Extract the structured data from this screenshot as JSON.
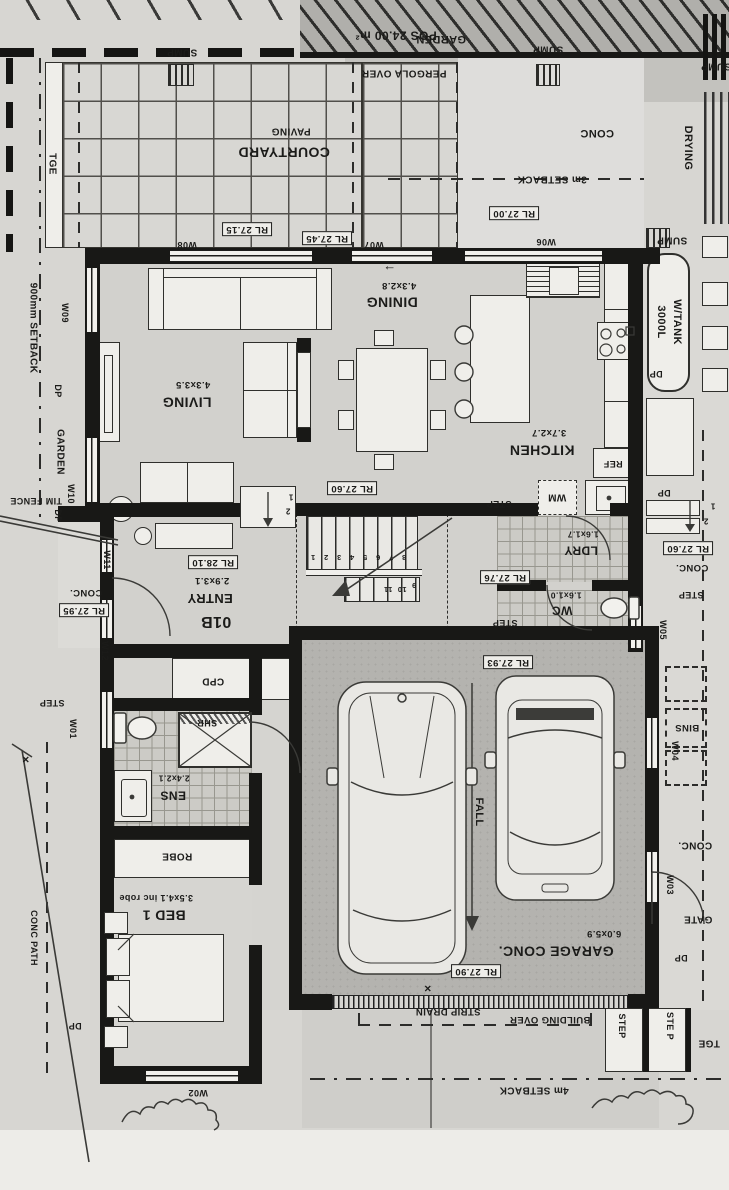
{
  "meta": {
    "drawing_type": "architectural floor plan (scanned, sheet rotated 180°)"
  },
  "colors": {
    "paper": "#d7d6d2",
    "wall": "#181816",
    "garage": "#b4b3af",
    "paving": "#d8d7d3",
    "exterior": "#dad9d5",
    "line": "#3a3a37"
  },
  "rooms": {
    "living": {
      "name": "LIVING",
      "dim": "4.3x3.5"
    },
    "dining": {
      "name": "DINING",
      "dim": "4.3x2.8"
    },
    "kitchen": {
      "name": "KITCHEN",
      "dim": "3.7x2.7"
    },
    "entry": {
      "name": "ENTRY",
      "dim": "2.9x3.1",
      "unit": "01B"
    },
    "ldry": {
      "name": "LDRY",
      "dim": "1.6x1.7"
    },
    "wc": {
      "name": "WC",
      "dim": "1.6x1.0"
    },
    "ens": {
      "name": "ENS",
      "dim": "2.4x2.1"
    },
    "bed1": {
      "name": "BED 1",
      "dim": "3.5x4.1 inc robe"
    },
    "garage": {
      "name": "GARAGE CONC.",
      "dim": "6.0x5.9"
    }
  },
  "levels": [
    "RL 27.00",
    "RL 27.15",
    "RL 27.45",
    "RL 27.60",
    "RL 27.60",
    "RL 27.76",
    "RL 27.90",
    "RL 27.93",
    "RL 27.95",
    "RL 28.10"
  ],
  "site_notes": [
    "POS 24.00 m²",
    "3m SETBACK",
    "4m SETBACK",
    "900mm SETBACK",
    "PERGOLA OVER",
    "BUILDING OVER",
    "STRIP DRAIN",
    "TIM FENCE",
    "CONC PATH",
    "3000L W/TANK",
    "DRYING",
    "BINS",
    "GATE"
  ],
  "labels": [
    {
      "id": "pos-area",
      "t": "POS 24.00 m²",
      "x": 396,
      "y": 35,
      "r": 180,
      "s": 12
    },
    {
      "id": "sump-1",
      "t": "SUMP",
      "x": 182,
      "y": 52,
      "r": 180,
      "s": 10
    },
    {
      "id": "garden-top",
      "t": "GARDEN",
      "x": 441,
      "y": 39,
      "r": 180,
      "s": 11
    },
    {
      "id": "sump-2",
      "t": "SUMP",
      "x": 548,
      "y": 49,
      "r": 180,
      "s": 10
    },
    {
      "id": "sump-3",
      "t": "SUMP",
      "x": 716,
      "y": 66,
      "r": 180,
      "s": 10
    },
    {
      "id": "pergola-over",
      "t": "PERGOLA OVER",
      "x": 404,
      "y": 73,
      "r": 180,
      "s": 10
    },
    {
      "id": "drying",
      "t": "DRYING",
      "x": 688,
      "y": 148,
      "r": 90,
      "s": 11
    },
    {
      "id": "paving",
      "t": "PAVING",
      "x": 291,
      "y": 131,
      "r": 180,
      "s": 10
    },
    {
      "id": "courtyard",
      "t": "COURTYARD",
      "x": 284,
      "y": 152,
      "r": 180,
      "s": 14
    },
    {
      "id": "tge-left",
      "t": "TGE",
      "x": 52,
      "y": 164,
      "r": 90,
      "s": 10
    },
    {
      "id": "conc-top",
      "t": "CONC",
      "x": 597,
      "y": 133,
      "r": 180,
      "s": 11
    },
    {
      "id": "setback-3m",
      "t": "3m SETBACK",
      "x": 552,
      "y": 179,
      "r": 180,
      "s": 10
    },
    {
      "id": "rl-27-00",
      "t": "RL 27.00",
      "x": 514,
      "y": 213,
      "r": 180,
      "s": 9.5,
      "box": true
    },
    {
      "id": "rl-27-15",
      "t": "RL 27.15",
      "x": 247,
      "y": 229,
      "r": 180,
      "s": 9.5,
      "box": true
    },
    {
      "id": "rl-27-45",
      "t": "RL 27.45",
      "x": 327,
      "y": 238,
      "r": 180,
      "s": 9.5,
      "box": true
    },
    {
      "id": "w08",
      "t": "W08",
      "x": 187,
      "y": 244,
      "r": 180,
      "s": 9
    },
    {
      "id": "w07",
      "t": "W07",
      "x": 374,
      "y": 244,
      "r": 180,
      "s": 9
    },
    {
      "id": "w06",
      "t": "W06",
      "x": 546,
      "y": 241,
      "r": 180,
      "s": 9
    },
    {
      "id": "sump-4",
      "t": "SUMP",
      "x": 672,
      "y": 240,
      "r": 180,
      "s": 10
    },
    {
      "id": "tank-line1",
      "t": "3000L",
      "x": 661,
      "y": 322,
      "r": 90,
      "s": 11
    },
    {
      "id": "tank-line2",
      "t": "W/TANK",
      "x": 677,
      "y": 322,
      "r": 90,
      "s": 11
    },
    {
      "id": "dp-tank",
      "t": "DP",
      "x": 656,
      "y": 373,
      "r": 180,
      "s": 9
    },
    {
      "id": "dining-arrow",
      "t": "←",
      "x": 390,
      "y": 266,
      "r": 0,
      "s": 13
    },
    {
      "id": "dining-dim",
      "t": "4.3x2.8",
      "x": 399,
      "y": 285,
      "r": 180,
      "s": 9.5
    },
    {
      "id": "dining",
      "t": "DINING",
      "x": 392,
      "y": 302,
      "r": 180,
      "s": 14
    },
    {
      "id": "living-dim",
      "t": "4.3x3.5",
      "x": 193,
      "y": 384,
      "r": 180,
      "s": 9.5
    },
    {
      "id": "living",
      "t": "LIVING",
      "x": 187,
      "y": 402,
      "r": 180,
      "s": 14
    },
    {
      "id": "w09",
      "t": "W09",
      "x": 64,
      "y": 313,
      "r": 90,
      "s": 9
    },
    {
      "id": "dp-left-1",
      "t": "DP",
      "x": 57,
      "y": 391,
      "r": 90,
      "s": 9
    },
    {
      "id": "garden-left",
      "t": "GARDEN",
      "x": 60,
      "y": 452,
      "r": 90,
      "s": 10
    },
    {
      "id": "w10",
      "t": "W10",
      "x": 70,
      "y": 494,
      "r": 90,
      "s": 9
    },
    {
      "id": "dp-left-2",
      "t": "DP",
      "x": 57,
      "y": 516,
      "r": 90,
      "s": 9
    },
    {
      "id": "tim-fence",
      "t": "TIM FENCE",
      "x": 36,
      "y": 500,
      "r": 180,
      "s": 9
    },
    {
      "id": "kitchen-dim",
      "t": "3.7x2.7",
      "x": 549,
      "y": 432,
      "r": 180,
      "s": 9.5
    },
    {
      "id": "kitchen",
      "t": "KITCHEN",
      "x": 542,
      "y": 450,
      "r": 180,
      "s": 14
    },
    {
      "id": "ref",
      "t": "REF",
      "x": 613,
      "y": 463,
      "r": 180,
      "s": 9
    },
    {
      "id": "rl-27-60-a",
      "t": "RL 27.60",
      "x": 352,
      "y": 488,
      "r": 180,
      "s": 9.5,
      "box": true
    },
    {
      "id": "wm",
      "t": "WM",
      "x": 557,
      "y": 497,
      "r": 180,
      "s": 10
    },
    {
      "id": "step-1",
      "t": "STEP",
      "x": 499,
      "y": 503,
      "r": 180,
      "s": 9
    },
    {
      "id": "dp-right-1",
      "t": "DP",
      "x": 664,
      "y": 492,
      "r": 180,
      "s": 9
    },
    {
      "id": "stepnum-r1",
      "t": "1",
      "x": 713,
      "y": 505,
      "r": 180,
      "s": 8
    },
    {
      "id": "stepnum-r2",
      "t": "2",
      "x": 706,
      "y": 520,
      "r": 180,
      "s": 8
    },
    {
      "id": "rl-27-60-b",
      "t": "RL 27.60",
      "x": 688,
      "y": 548,
      "r": 180,
      "s": 9.5,
      "box": true
    },
    {
      "id": "conc-right-1",
      "t": "CONC.",
      "x": 692,
      "y": 567,
      "r": 180,
      "s": 9.5
    },
    {
      "id": "step-2",
      "t": "STEP",
      "x": 691,
      "y": 594,
      "r": 180,
      "s": 9
    },
    {
      "id": "w05",
      "t": "W05",
      "x": 662,
      "y": 630,
      "r": 90,
      "s": 9
    },
    {
      "id": "ldry-dim",
      "t": "1.6x1.7",
      "x": 583,
      "y": 534,
      "r": 180,
      "s": 8.5
    },
    {
      "id": "ldry",
      "t": "LDRY",
      "x": 581,
      "y": 550,
      "r": 180,
      "s": 12
    },
    {
      "id": "rl-27-76",
      "t": "RL 27.76",
      "x": 505,
      "y": 577,
      "r": 180,
      "s": 9.5,
      "box": true
    },
    {
      "id": "wc-dim",
      "t": "1.6x1.0",
      "x": 566,
      "y": 595,
      "r": 180,
      "s": 8.5
    },
    {
      "id": "wc",
      "t": "WC",
      "x": 562,
      "y": 610,
      "r": 180,
      "s": 12
    },
    {
      "id": "step-3",
      "t": "STEP",
      "x": 505,
      "y": 622,
      "r": 180,
      "s": 9
    },
    {
      "id": "rl-28-10",
      "t": "RL 28.10",
      "x": 213,
      "y": 562,
      "r": 180,
      "s": 9.5,
      "box": true
    },
    {
      "id": "entry-dim",
      "t": "2.9x3.1",
      "x": 212,
      "y": 580,
      "r": 180,
      "s": 9.5
    },
    {
      "id": "entry",
      "t": "ENTRY",
      "x": 210,
      "y": 598,
      "r": 180,
      "s": 13
    },
    {
      "id": "unit",
      "t": "01B",
      "x": 216,
      "y": 621,
      "r": 180,
      "s": 16,
      "w": 800
    },
    {
      "id": "cpd",
      "t": "CPD",
      "x": 213,
      "y": 681,
      "r": 180,
      "s": 10
    },
    {
      "id": "shr",
      "t": "SHR",
      "x": 207,
      "y": 722,
      "r": 180,
      "s": 9
    },
    {
      "id": "ens-dim",
      "t": "2.4x2.1",
      "x": 174,
      "y": 778,
      "r": 180,
      "s": 8.5
    },
    {
      "id": "ens",
      "t": "ENS",
      "x": 173,
      "y": 795,
      "r": 180,
      "s": 12
    },
    {
      "id": "robe",
      "t": "ROBE",
      "x": 177,
      "y": 856,
      "r": 180,
      "s": 10
    },
    {
      "id": "bed1-dim",
      "t": "3.5x4.1 inc robe",
      "x": 156,
      "y": 897,
      "r": 180,
      "s": 9
    },
    {
      "id": "bed1",
      "t": "BED 1",
      "x": 164,
      "y": 915,
      "r": 180,
      "s": 14
    },
    {
      "id": "w01",
      "t": "W01",
      "x": 72,
      "y": 729,
      "r": 90,
      "s": 9
    },
    {
      "id": "step-4",
      "t": "STEP",
      "x": 52,
      "y": 702,
      "r": 180,
      "s": 9
    },
    {
      "id": "rl-27-95",
      "t": "RL 27.95",
      "x": 84,
      "y": 610,
      "r": 180,
      "s": 9.5,
      "box": true
    },
    {
      "id": "conc-left",
      "t": "CONC.",
      "x": 86,
      "y": 592,
      "r": 180,
      "s": 9.5
    },
    {
      "id": "w11",
      "t": "W11",
      "x": 106,
      "y": 560,
      "r": 90,
      "s": 9
    },
    {
      "id": "w12",
      "t": "W12",
      "x": 104,
      "y": 651,
      "r": 90,
      "s": 9
    },
    {
      "id": "rl-27-93",
      "t": "RL 27.93",
      "x": 508,
      "y": 662,
      "r": 180,
      "s": 9.5,
      "box": true
    },
    {
      "id": "fall",
      "t": "FALL",
      "x": 479,
      "y": 812,
      "r": 90,
      "s": 11
    },
    {
      "id": "garage",
      "t": "GARAGE CONC.",
      "x": 556,
      "y": 951,
      "r": 180,
      "s": 14
    },
    {
      "id": "garage-dim",
      "t": "6.0x5.9",
      "x": 604,
      "y": 933,
      "r": 180,
      "s": 9.5
    },
    {
      "id": "rl-27-90",
      "t": "RL 27.90",
      "x": 476,
      "y": 971,
      "r": 180,
      "s": 9.5,
      "box": true
    },
    {
      "id": "bins",
      "t": "BINS",
      "x": 687,
      "y": 727,
      "r": 180,
      "s": 9.5
    },
    {
      "id": "w04",
      "t": "W04",
      "x": 674,
      "y": 751,
      "r": 90,
      "s": 9
    },
    {
      "id": "conc-right-2",
      "t": "CONC.",
      "x": 695,
      "y": 845,
      "r": 180,
      "s": 10
    },
    {
      "id": "w03",
      "t": "W03",
      "x": 669,
      "y": 885,
      "r": 90,
      "s": 9
    },
    {
      "id": "gate",
      "t": "GATE",
      "x": 698,
      "y": 919,
      "r": 180,
      "s": 10
    },
    {
      "id": "dp-gate",
      "t": "DP",
      "x": 681,
      "y": 957,
      "r": 180,
      "s": 9
    },
    {
      "id": "strip-drain",
      "t": "STRIP DRAIN",
      "x": 448,
      "y": 1011,
      "r": 180,
      "s": 9.5
    },
    {
      "id": "building-over",
      "t": "BUILDING OVER",
      "x": 550,
      "y": 1019,
      "r": 180,
      "s": 9.5
    },
    {
      "id": "setback-4m",
      "t": "4m SETBACK",
      "x": 534,
      "y": 1090,
      "r": 180,
      "s": 10
    },
    {
      "id": "step-5",
      "t": "STEP",
      "x": 621,
      "y": 1026,
      "r": 90,
      "s": 9
    },
    {
      "id": "step-6",
      "t": "STE P",
      "x": 669,
      "y": 1026,
      "r": 90,
      "s": 9
    },
    {
      "id": "tge-bottom",
      "t": "TGE",
      "x": 709,
      "y": 1043,
      "r": 180,
      "s": 10
    },
    {
      "id": "dp-bed",
      "t": "DP",
      "x": 75,
      "y": 1025,
      "r": 180,
      "s": 9
    },
    {
      "id": "w02",
      "t": "W02",
      "x": 198,
      "y": 1092,
      "r": 180,
      "s": 9
    },
    {
      "id": "conc-path",
      "t": "CONC PATH",
      "x": 33,
      "y": 938,
      "r": 90,
      "s": 9
    },
    {
      "id": "setback-900",
      "t": "900mm SETBACK",
      "x": 33,
      "y": 328,
      "r": 90,
      "s": 10
    },
    {
      "id": "cross-1",
      "t": "×",
      "x": 26,
      "y": 760,
      "r": 0,
      "s": 12
    },
    {
      "id": "cross-2",
      "t": "×",
      "x": 428,
      "y": 989,
      "r": 0,
      "s": 12
    },
    {
      "id": "stair-1",
      "t": "1",
      "x": 313,
      "y": 557,
      "r": 180,
      "s": 7.5
    },
    {
      "id": "stair-2",
      "t": "2",
      "x": 326,
      "y": 557,
      "r": 180,
      "s": 7.5
    },
    {
      "id": "stair-3",
      "t": "3",
      "x": 339,
      "y": 557,
      "r": 180,
      "s": 7.5
    },
    {
      "id": "stair-4",
      "t": "4",
      "x": 352,
      "y": 557,
      "r": 180,
      "s": 7.5
    },
    {
      "id": "stair-5",
      "t": "5",
      "x": 365,
      "y": 557,
      "r": 180,
      "s": 7.5
    },
    {
      "id": "stair-6",
      "t": "6",
      "x": 378,
      "y": 557,
      "r": 180,
      "s": 7.5
    },
    {
      "id": "stair-7",
      "t": "7",
      "x": 391,
      "y": 557,
      "r": 180,
      "s": 7.5
    },
    {
      "id": "stair-8",
      "t": "8",
      "x": 404,
      "y": 557,
      "r": 180,
      "s": 7.5
    },
    {
      "id": "stair-9",
      "t": "9",
      "x": 414,
      "y": 585,
      "r": 180,
      "s": 7.5
    },
    {
      "id": "stair-10",
      "t": "10",
      "x": 402,
      "y": 589,
      "r": 180,
      "s": 7.5
    },
    {
      "id": "stair-11",
      "t": "11",
      "x": 388,
      "y": 589,
      "r": 180,
      "s": 7.5
    },
    {
      "id": "stepnum-l1",
      "t": "1",
      "x": 291,
      "y": 496,
      "r": 180,
      "s": 8
    },
    {
      "id": "stepnum-l2",
      "t": "2",
      "x": 288,
      "y": 510,
      "r": 180,
      "s": 8
    }
  ]
}
